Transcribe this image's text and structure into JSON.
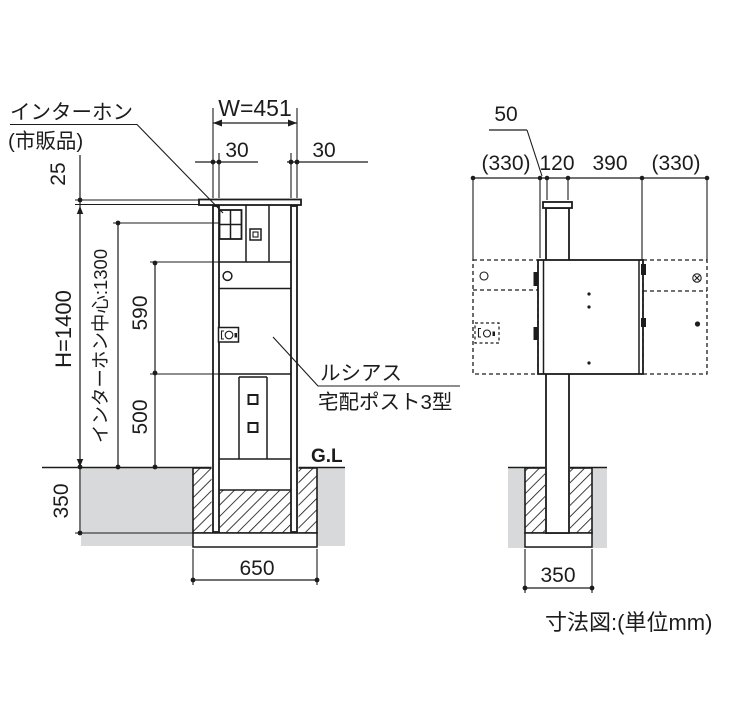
{
  "caption": "寸法図:(単位mm)",
  "front_view": {
    "labels": {
      "intercom_line1": "インターホン",
      "intercom_line2": "(市販品)",
      "product_line1": "ルシアス",
      "product_line2": "宅配ポスト3型",
      "ground_level": "G.L"
    },
    "dims": {
      "overall_width": "W=451",
      "post_width_left": "30",
      "post_width_right": "30",
      "cap_height": "25",
      "overall_height": "H=1400",
      "intercom_center": "インターホン中心:1300",
      "upper_section": "590",
      "lower_section": "500",
      "embed_depth": "350",
      "foundation_width": "650"
    }
  },
  "side_view": {
    "dims": {
      "front_clearance": "50",
      "door_swing_front": "(330)",
      "post_depth": "120",
      "body_depth": "390",
      "door_swing_rear": "(330)",
      "foundation_width": "350"
    }
  },
  "colors": {
    "line": "#1c1c1c",
    "ground_fill": "#d8d9da",
    "background": "#ffffff"
  }
}
